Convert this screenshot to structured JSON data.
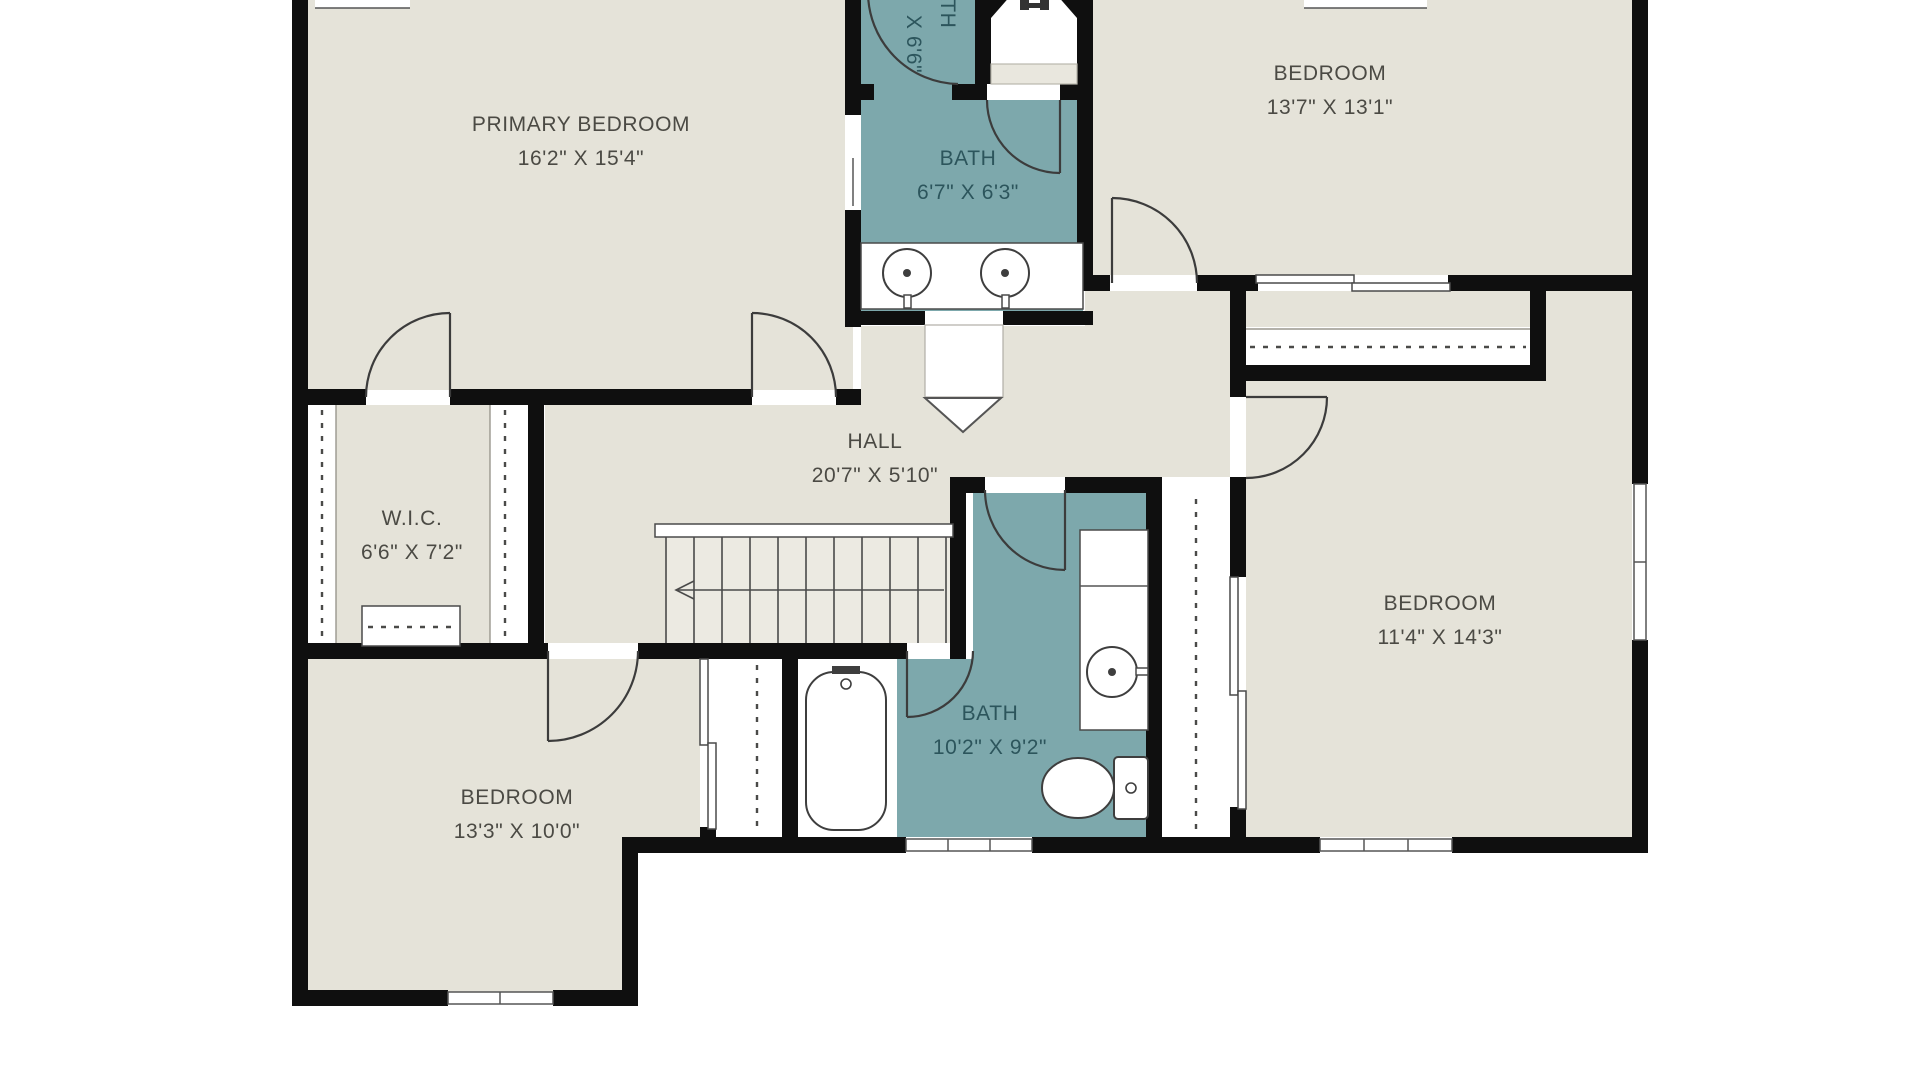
{
  "plan": {
    "type": "floor-plan",
    "colors": {
      "background": "#ffffff",
      "wall": "#0f0f0f",
      "floor": "#e5e3d9",
      "floor_light": "#eceae2",
      "wet_room": "#7da8ac",
      "shelf": "#e9e7de",
      "label": "#4b4a44",
      "wet_label": "#2c555c"
    },
    "rooms": [
      {
        "id": "primary-bedroom",
        "name": "PRIMARY BEDROOM",
        "dims": "16'2\" X 15'4\""
      },
      {
        "id": "bath-top",
        "name": "BATH",
        "dims": "X 6'6\""
      },
      {
        "id": "bedroom-top-right",
        "name": "BEDROOM",
        "dims": "13'7\" X 13'1\""
      },
      {
        "id": "bath-center",
        "name": "BATH",
        "dims": "6'7\" X 6'3\""
      },
      {
        "id": "hall",
        "name": "HALL",
        "dims": "20'7\" X 5'10\""
      },
      {
        "id": "wic",
        "name": "W.I.C.",
        "dims": "6'6\" X 7'2\""
      },
      {
        "id": "bedroom-right",
        "name": "BEDROOM",
        "dims": "11'4\" X 14'3\""
      },
      {
        "id": "bath-lower",
        "name": "BATH",
        "dims": "10'2\" X 9'2\""
      },
      {
        "id": "bedroom-bottom-left",
        "name": "BEDROOM",
        "dims": "13'3\" X 10'0\""
      }
    ],
    "fixtures": [
      "double-vanity-sinks",
      "bathtub",
      "vanity-sink",
      "toilet",
      "stairs-down-arrow",
      "closet-rods",
      "archway-marker"
    ]
  }
}
